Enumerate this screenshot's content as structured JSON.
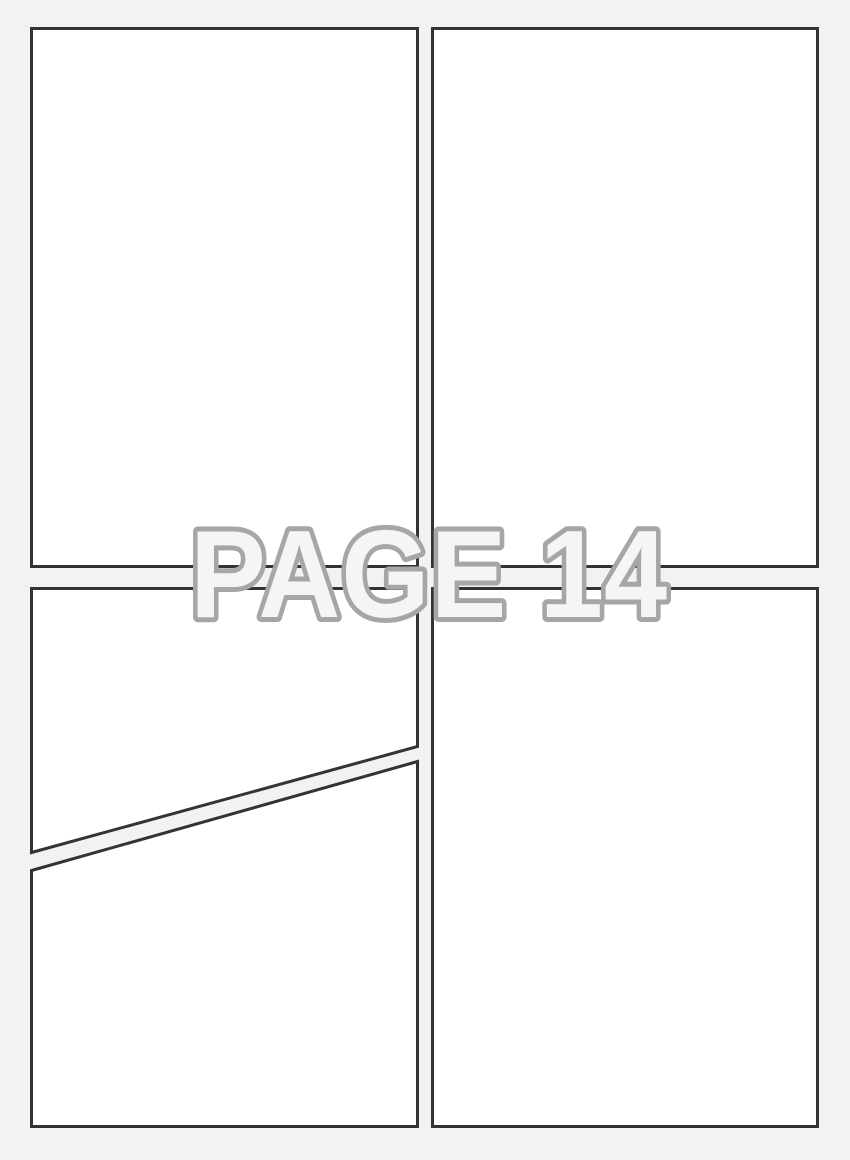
{
  "page": {
    "label": "PAGE 14"
  },
  "theme": {
    "background_color": "#f2f2f2",
    "panel_fill": "#ffffff",
    "panel_border_color": "#333333",
    "label_fill": "#f5f5f5",
    "label_stroke": "#a6a6a6"
  },
  "panels": [
    {
      "name": "top-left",
      "shape": "rectangle"
    },
    {
      "name": "top-right",
      "shape": "rectangle"
    },
    {
      "name": "middle-left-above-diagonal",
      "shape": "quadrilateral"
    },
    {
      "name": "bottom-left-below-diagonal",
      "shape": "quadrilateral"
    },
    {
      "name": "bottom-right",
      "shape": "rectangle"
    }
  ]
}
